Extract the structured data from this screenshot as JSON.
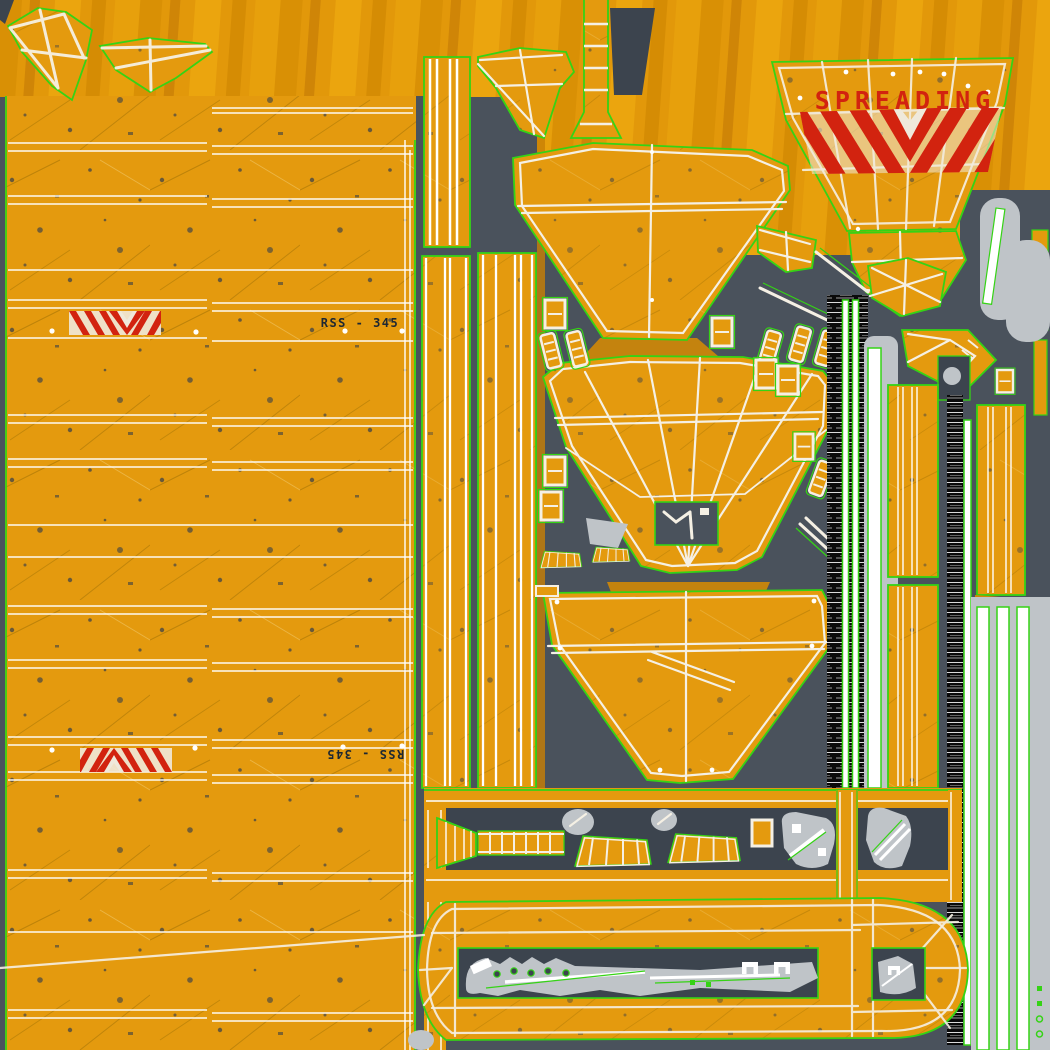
{
  "document": {
    "type": "uv-texture-atlas",
    "subject": "yellow heavy-equipment livery texture with UV seams and wireframe overlay",
    "canvas": {
      "width": 1050,
      "height": 1050
    }
  },
  "labels": {
    "spreading_decal": "SPREADING",
    "unit_id_decal_top": "RSS - 345",
    "unit_id_decal_bottom": "RSS - 345"
  },
  "colors": {
    "paint_orange": "#E49A0E",
    "paint_orange_deep": "#D18806",
    "paint_orange_ray": "#C87F05",
    "background_slate": "#4A525C",
    "background_slate_dark": "#3C444E",
    "uv_seam_green": "#35D315",
    "wireframe_white": "#F5F0E4",
    "decal_red": "#D2230F",
    "metal_gray": "#BFC4C8",
    "barcode_black": "#0A0A0A",
    "id_text_dark": "#1C2733"
  }
}
